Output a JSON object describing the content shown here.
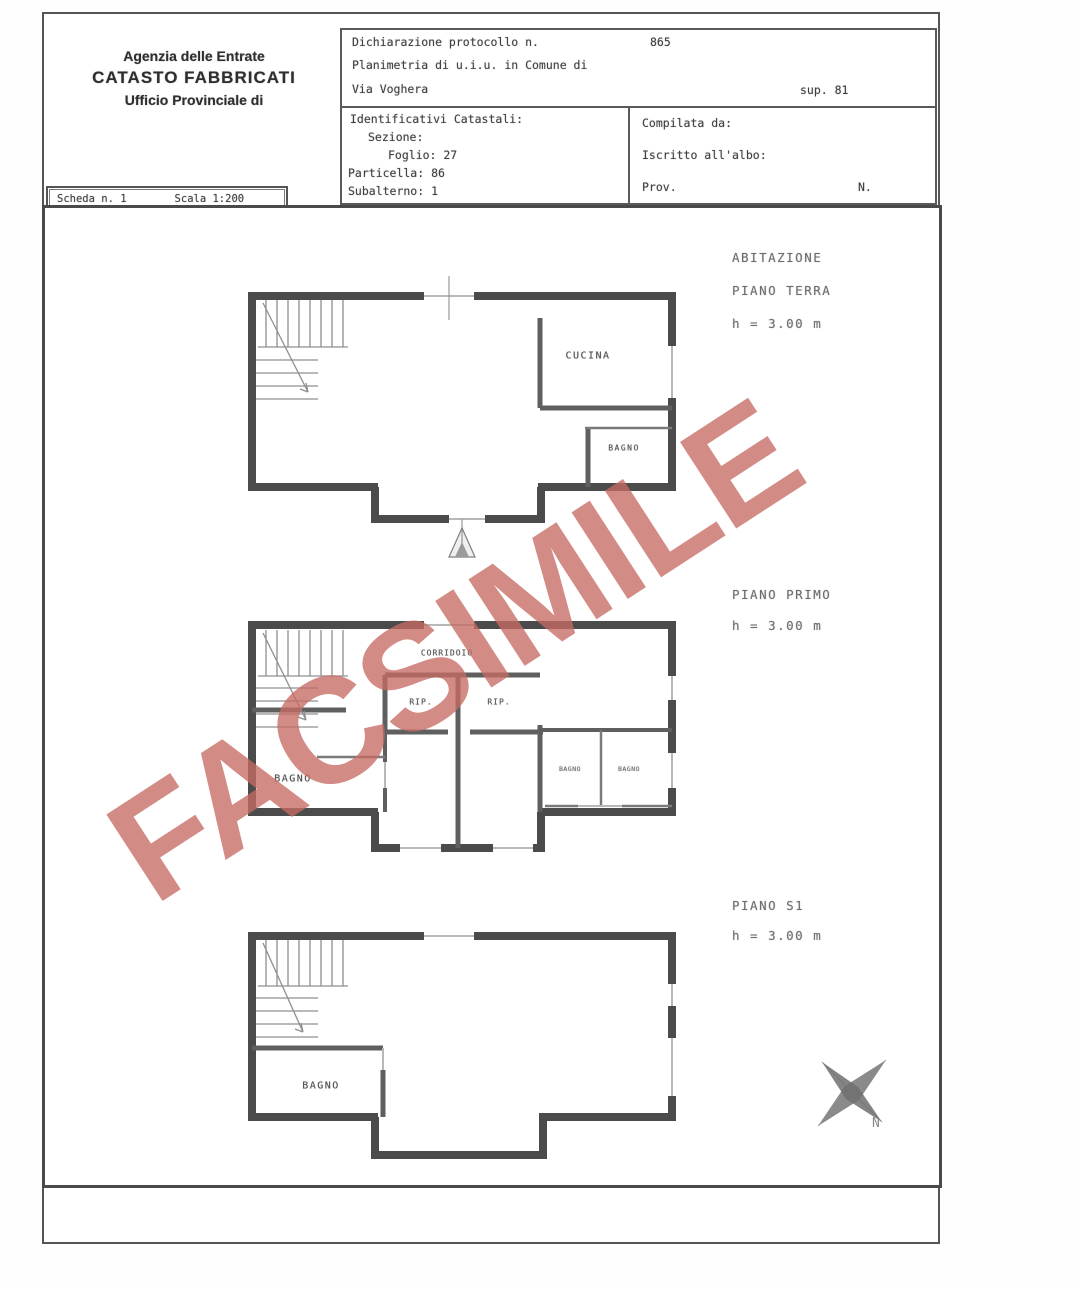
{
  "header": {
    "agency_line1": "Agenzia delle Entrate",
    "agency_line2": "CATASTO FABBRICATI",
    "agency_line3": "Ufficio Provinciale di",
    "protocol_label": "Dichiarazione protocollo n.",
    "protocol_number": "865",
    "planimetria_line": "Planimetria di u.i.u. in Comune di",
    "address": "Via Voghera",
    "sup_label": "sup. 81",
    "identificativi": {
      "title": "Identificativi Catastali:",
      "sezione": "Sezione:",
      "foglio": "Foglio: 27",
      "particella": "Particella: 86",
      "subalterno": "Subalterno: 1"
    },
    "compilata": {
      "title": "Compilata da:",
      "iscritto": "Iscritto all'albo:",
      "prov": "Prov.",
      "n": "N."
    }
  },
  "tab": {
    "scheda": "Scheda n. 1",
    "scala": "Scala 1:200"
  },
  "watermark": {
    "text": "FACSIMILE",
    "color": "#c76a64"
  },
  "plans": {
    "terra": {
      "title": "ABITAZIONE",
      "subtitle": "PIANO TERRA",
      "height": "h = 3.00 m",
      "rooms": {
        "cucina": "CUCINA",
        "bagno": "BAGNO"
      }
    },
    "primo": {
      "subtitle": "PIANO PRIMO",
      "height": "h = 3.00 m",
      "rooms": {
        "corridoio": "CORRIDOIO",
        "rip1": "RIP.",
        "rip2": "RIP.",
        "bagno_left": "BAGNO",
        "bagno_r1": "BAGNO",
        "bagno_r2": "BAGNO"
      }
    },
    "s1": {
      "subtitle": "PIANO S1",
      "height": "h = 3.00 m",
      "rooms": {
        "bagno": "BAGNO"
      }
    }
  },
  "compass": {
    "label": "N"
  }
}
